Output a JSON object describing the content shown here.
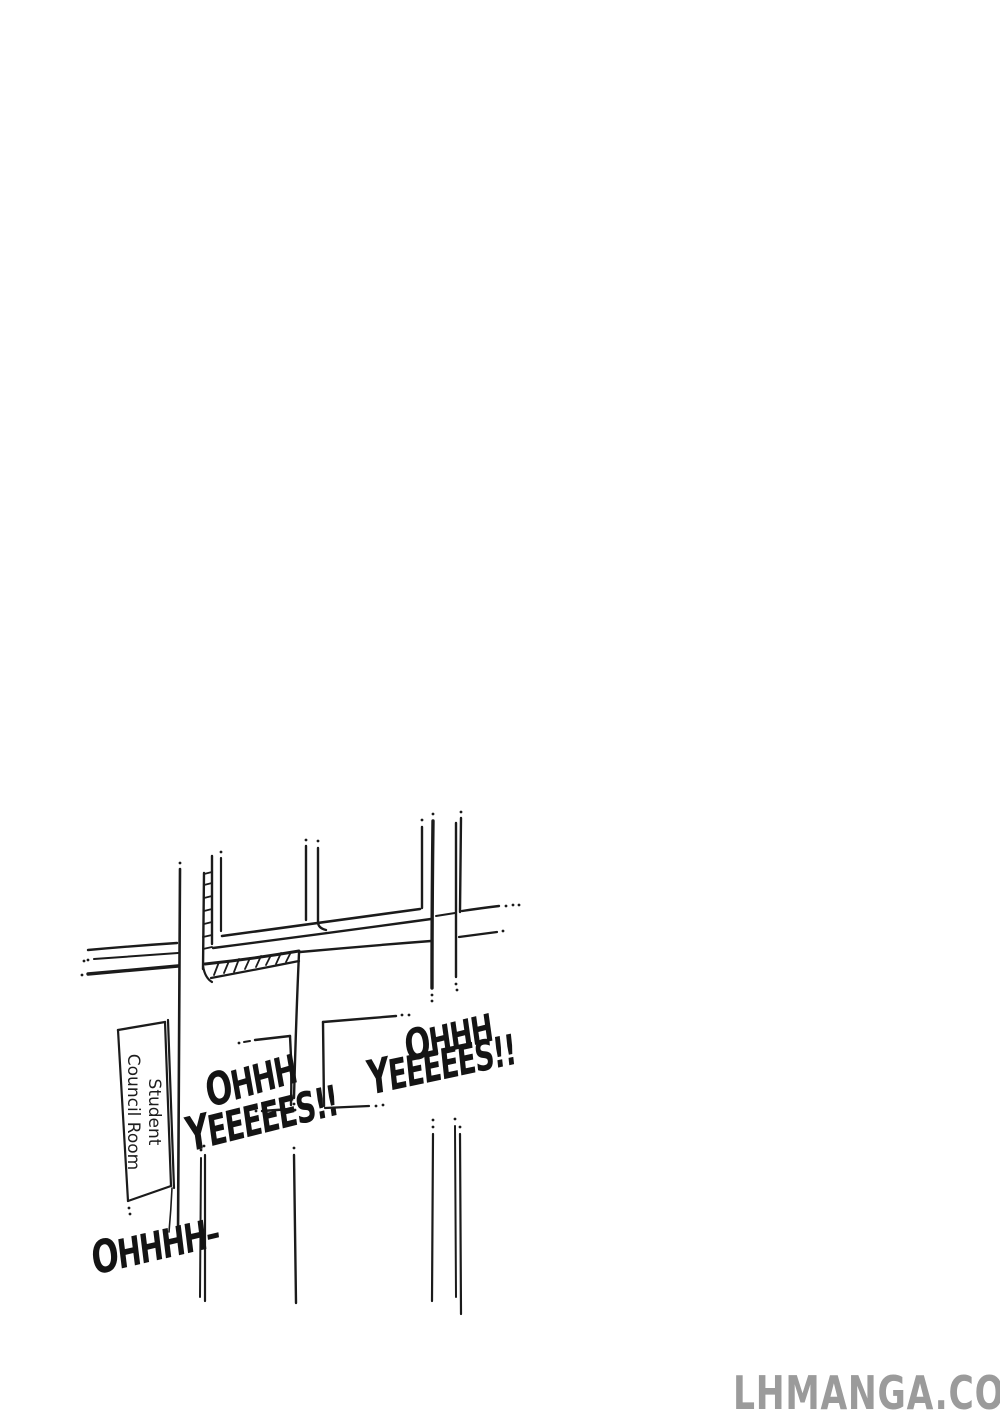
{
  "page": {
    "background": "#ffffff",
    "ink_color": "#1b1b1b"
  },
  "sign": {
    "line1": "Student",
    "line2": "Council Room"
  },
  "sfx": {
    "left_ohhh": "OHHH",
    "left_yes": "YEEEEES!!",
    "right_ohhh": "OHHH",
    "right_yes": "YEEEEES!!",
    "bottom_ohhh": "OHHHH–"
  },
  "watermark": {
    "text": "LHMANGA.COM",
    "color": "#9b9b9b"
  }
}
